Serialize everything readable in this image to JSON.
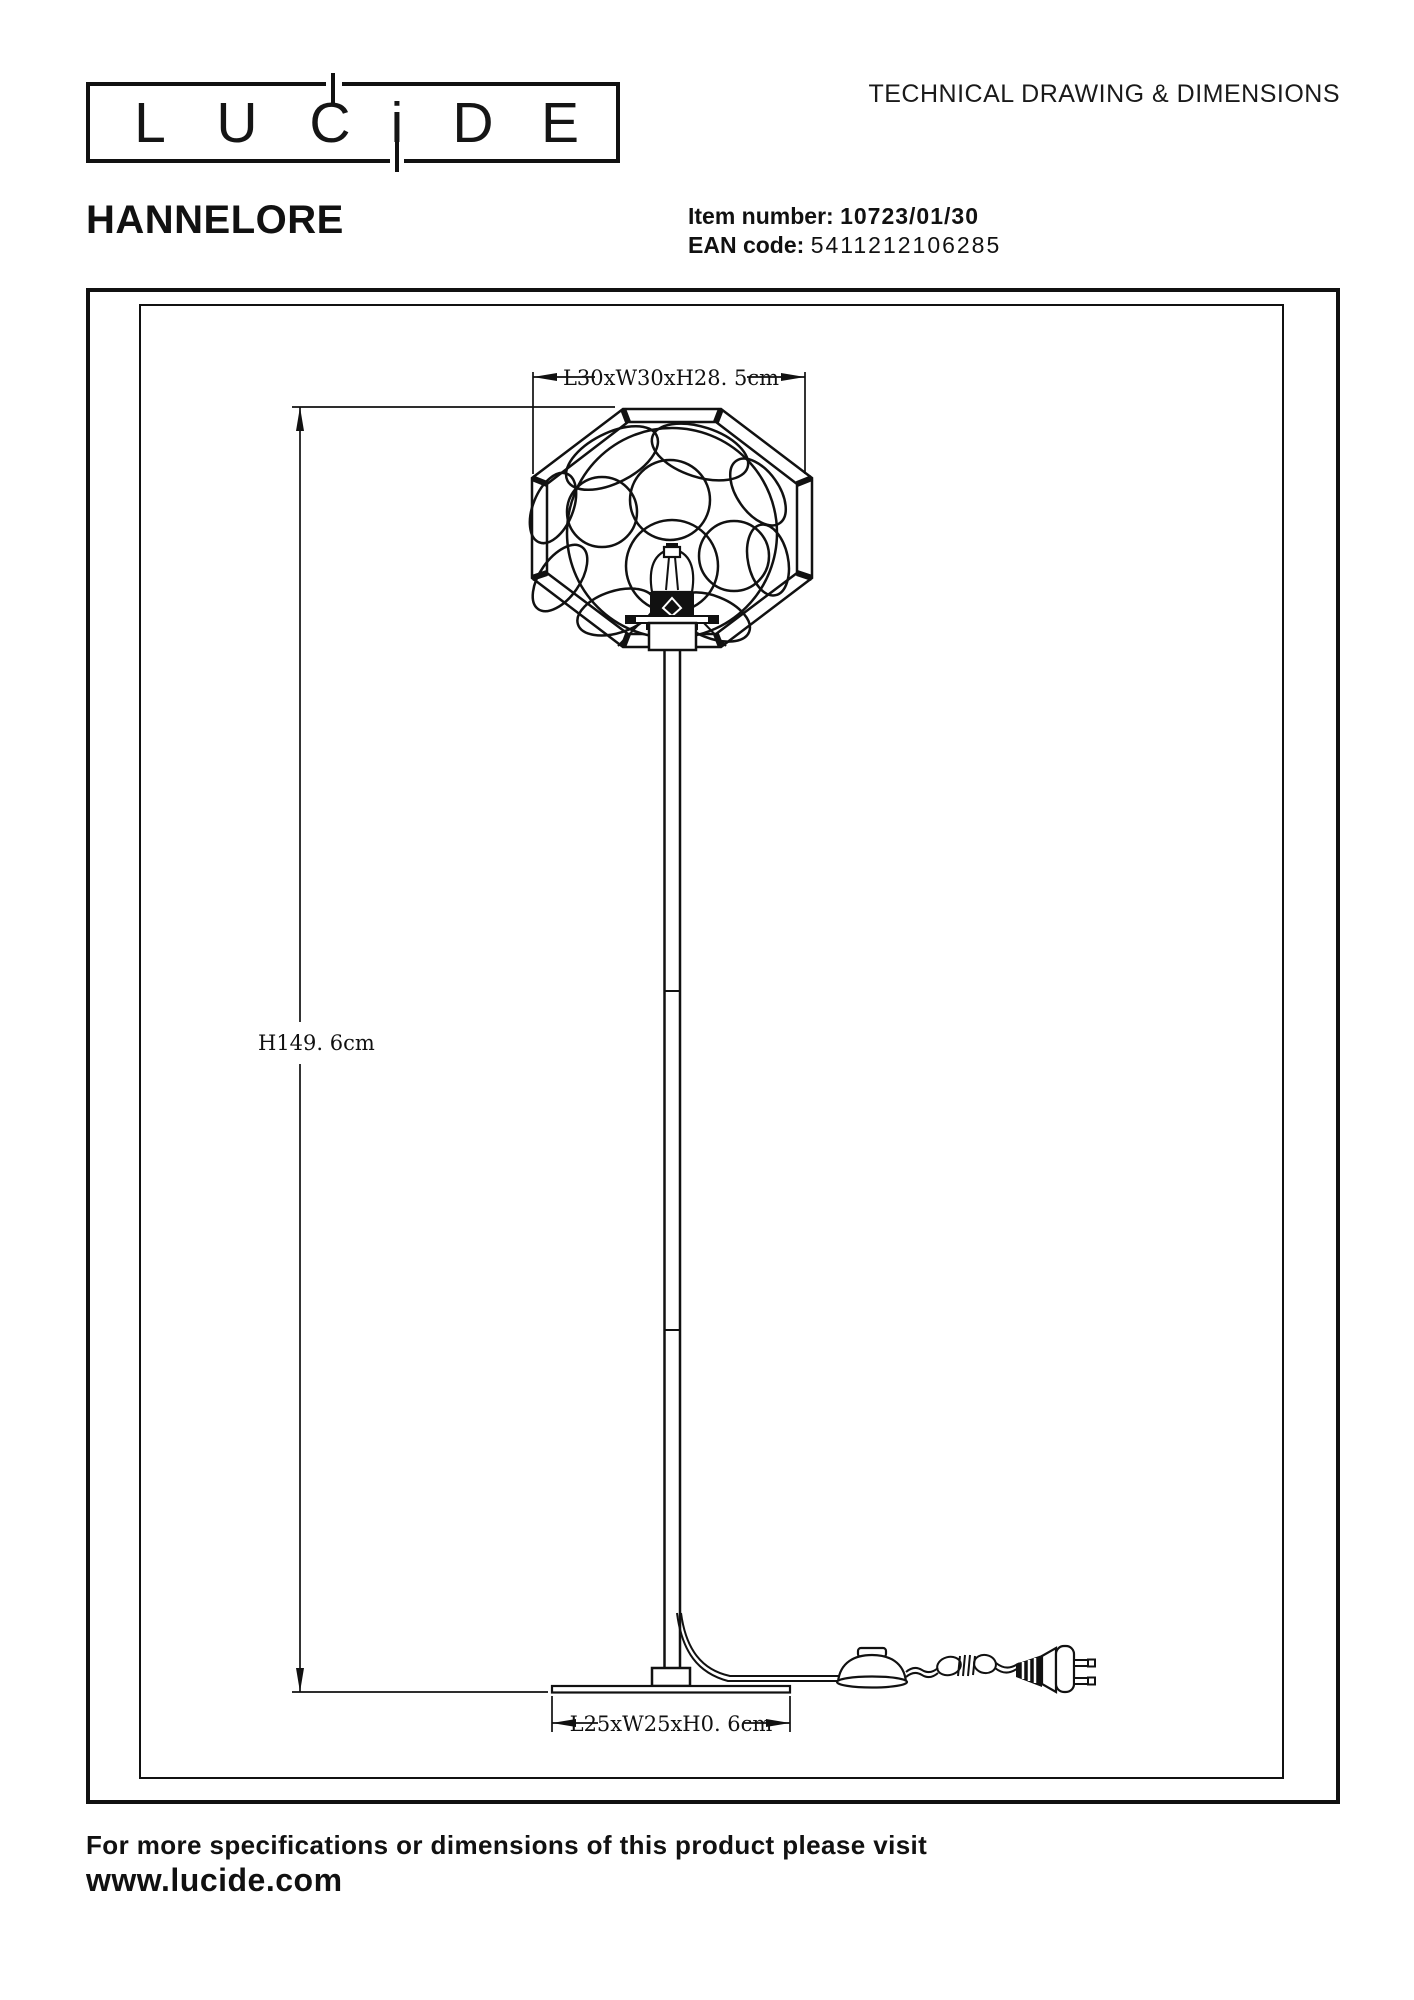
{
  "colors": {
    "ink": "#111111"
  },
  "header": {
    "logo_letters": [
      "L",
      "U",
      "C",
      "i",
      "D",
      "E"
    ],
    "sheet_title": "TECHNICAL DRAWING & DIMENSIONS"
  },
  "product": {
    "name": "HANNELORE",
    "item_label": "Item number:",
    "item_value": "10723/01/30",
    "ean_label": "EAN code:",
    "ean_value": "5411212106285"
  },
  "drawing": {
    "shade_dimension": "L30xW30xH28. 5cm",
    "height_dimension": "H149. 6cm",
    "base_dimension": "L25xW25xH0. 6cm"
  },
  "footer": {
    "line1": "For more specifications or dimensions of this product please visit",
    "line2": "www.lucide.com"
  }
}
